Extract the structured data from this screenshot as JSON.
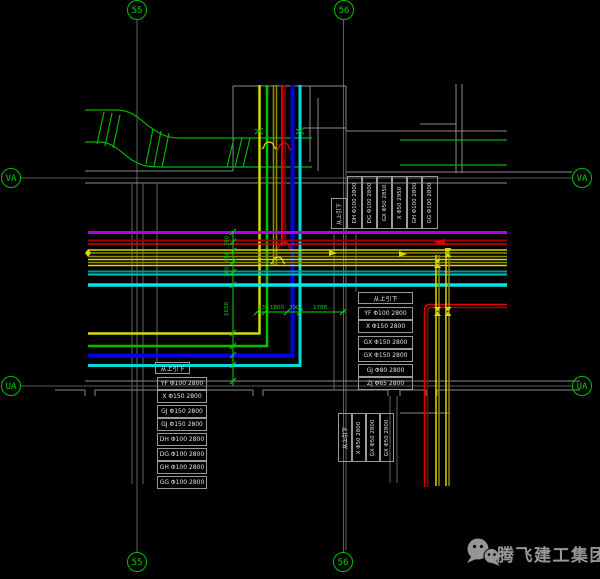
{
  "grid": {
    "b55_top": "55",
    "b56_top": "56",
    "bVA_left": "VA",
    "bVA_right": "VA",
    "bUA_left": "UA",
    "bUA_right": "UA",
    "b55_bottom": "55",
    "b56_bottom": "56"
  },
  "tables": {
    "top": {
      "header": "从上引下",
      "cols": [
        "DH Φ100 2800",
        "DG Φ100 2800",
        "GX Φ50 2850",
        "X Φ50 2950",
        "GH Φ100 2800",
        "GG Φ100 2800"
      ]
    },
    "mid_right": {
      "header": "从上引下",
      "rows": [
        "YF Φ100 2800",
        "X Φ150 2800",
        "GX Φ150 2800",
        "GX Φ150 2800",
        "GJ Φ80 2800",
        "ZJ Φ65 2800"
      ]
    },
    "bottom_left": {
      "header": "从上引下",
      "rows": [
        "YF Φ100 2800",
        "X Φ150 2800",
        "GJ Φ150 2800",
        "GJ Φ150 2800",
        "DH Φ100 2800",
        "DG Φ100 2800",
        "GH Φ100 2800",
        "GG Φ100 2800"
      ]
    },
    "bottom_center": {
      "header": "从上引下",
      "cols": [
        "X Φ50 2800",
        "GX Φ50 2800",
        "GX Φ50 2800"
      ]
    }
  },
  "dimensions": {
    "horizontal": [
      "130",
      "1800",
      "390",
      "1788"
    ],
    "vertical": [
      "350",
      "450",
      "700",
      "1650"
    ]
  },
  "watermark": {
    "company": "腾飞建工集团",
    "logo": "wechat-icon"
  },
  "colors": {
    "background": "#000000",
    "grid_green": "#00c000",
    "duct_green": "#00b400",
    "dim_green": "#00d800",
    "pipe_magenta": "#b400e6",
    "pipe_red": "#e00000",
    "pipe_dark_red": "#a00000",
    "pipe_yellow": "#d8d800",
    "pipe_olive": "#8f8f00",
    "pipe_blue": "#0000e0",
    "pipe_cyan": "#00e8e8",
    "pipe_teal": "#009898",
    "wall_gray": "#8a8a8a",
    "text_white": "#e2e2e2",
    "watermark_gray": "#979797"
  }
}
